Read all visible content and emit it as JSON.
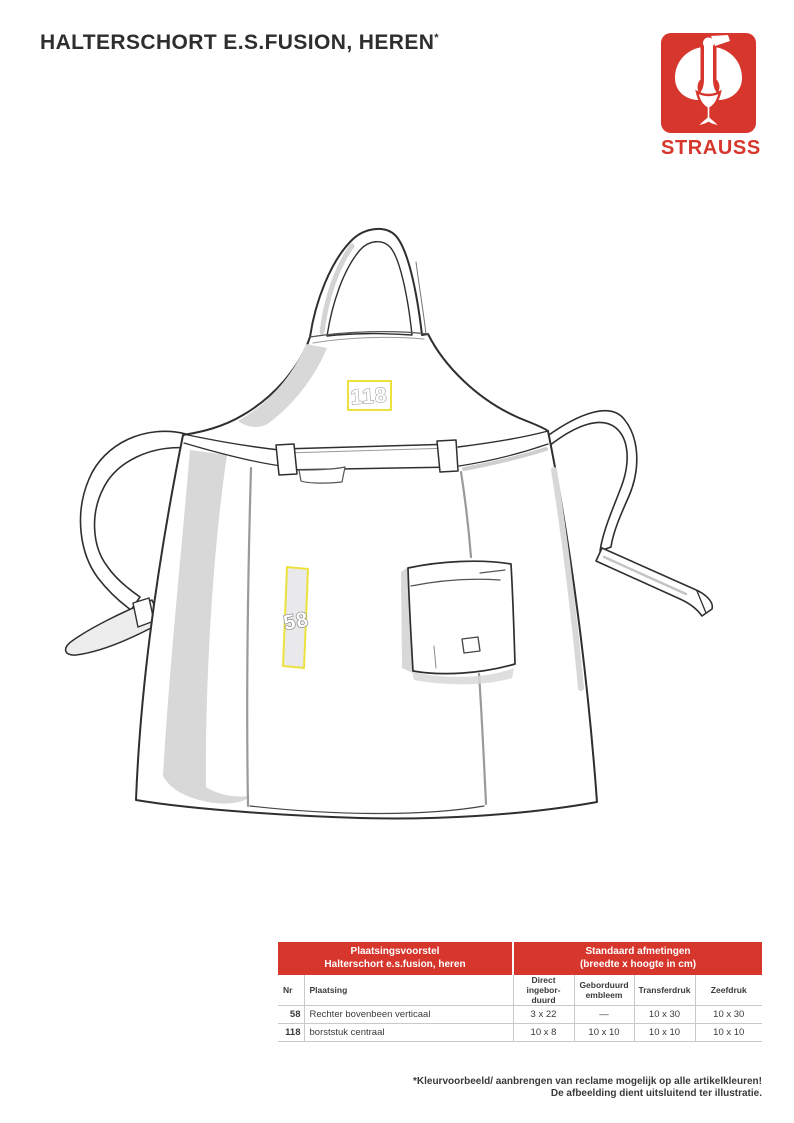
{
  "title": "HALTERSCHORT E.S.FUSION, HEREN",
  "title_note_symbol": "*",
  "logo": {
    "brand": "STRAUSS"
  },
  "colors": {
    "brand_red": "#d6362c",
    "highlight_yellow": "#ece23f"
  },
  "apron": {
    "marker_118": "118",
    "marker_58": "58"
  },
  "table": {
    "header_left_line1": "Plaatsingsvoorstel",
    "header_left_line2": "Halterschort e.s.fusion, heren",
    "header_right_line1": "Standaard afmetingen",
    "header_right_line2": "(breedte x hoogte in cm)",
    "columns": {
      "nr": "Nr",
      "plaatsing": "Plaatsing",
      "col3_line1": "Direct ingebor-",
      "col3_line2": "duurd",
      "col4_line1": "Geborduurd",
      "col4_line2": "embleem",
      "col5": "Transferdruk",
      "col6": "Zeefdruk"
    },
    "rows": [
      {
        "nr": "58",
        "plaatsing": "Rechter bovenbeen verticaal",
        "v1": "3 x 22",
        "v2": "—",
        "v3": "10 x 30",
        "v4": "10 x 30"
      },
      {
        "nr": "118",
        "plaatsing": "borststuk centraal",
        "v1": "10 x 8",
        "v2": "10 x 10",
        "v3": "10 x 10",
        "v4": "10 x 10"
      }
    ]
  },
  "footnote": {
    "line1": "*Kleurvoorbeeld/ aanbrengen van reclame mogelijk op alle artikelkleuren!",
    "line2": "De afbeelding dient uitsluitend ter illustratie."
  }
}
